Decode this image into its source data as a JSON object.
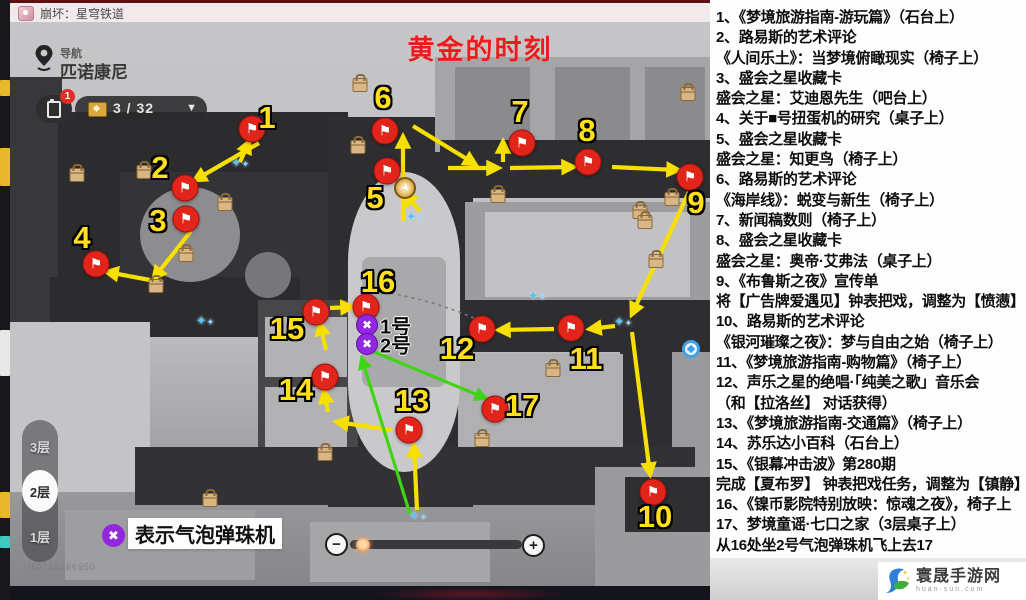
{
  "window": {
    "title": "崩坏：星穹铁道"
  },
  "map": {
    "overlay_title": "黄金的时刻",
    "nav_label": "导航",
    "nav_location": "匹诺康尼",
    "collection_count": "3 / 32",
    "tasks_badge": "1",
    "floors": [
      {
        "label": "3层",
        "selected": false
      },
      {
        "label": "2层",
        "selected": true
      },
      {
        "label": "1层",
        "selected": false
      }
    ],
    "legend": {
      "symbol": "✖",
      "label": "表示气泡弹珠机"
    },
    "uid": "UID116166950",
    "zoom_controls": {
      "minus": "−",
      "plus": "+"
    },
    "flag_symbol": "⚑",
    "markers": [
      {
        "n": "1",
        "fx": 242,
        "fy": 107,
        "lx": 257,
        "ly": 96
      },
      {
        "n": "2",
        "fx": 175,
        "fy": 166,
        "lx": 150,
        "ly": 146
      },
      {
        "n": "3",
        "fx": 176,
        "fy": 197,
        "lx": 148,
        "ly": 199
      },
      {
        "n": "4",
        "fx": 86,
        "fy": 242,
        "lx": 72,
        "ly": 216
      },
      {
        "n": "5",
        "fx": 377,
        "fy": 149,
        "lx": 365,
        "ly": 176
      },
      {
        "n": "6",
        "fx": 375,
        "fy": 109,
        "lx": 373,
        "ly": 76
      },
      {
        "n": "7",
        "fx": 512,
        "fy": 121,
        "lx": 510,
        "ly": 90
      },
      {
        "n": "8",
        "fx": 578,
        "fy": 140,
        "lx": 577,
        "ly": 109
      },
      {
        "n": "9",
        "fx": 680,
        "fy": 155,
        "lx": 686,
        "ly": 181
      },
      {
        "n": "10",
        "fx": 643,
        "fy": 470,
        "lx": 645,
        "ly": 495
      },
      {
        "n": "11",
        "fx": 561,
        "fy": 306,
        "lx": 576,
        "ly": 337
      },
      {
        "n": "12",
        "fx": 472,
        "fy": 307,
        "lx": 447,
        "ly": 327
      },
      {
        "n": "13",
        "fx": 399,
        "fy": 408,
        "lx": 402,
        "ly": 379
      },
      {
        "n": "14",
        "fx": 315,
        "fy": 355,
        "lx": 286,
        "ly": 368
      },
      {
        "n": "15",
        "fx": 306,
        "fy": 290,
        "lx": 277,
        "ly": 307
      },
      {
        "n": "16",
        "fx": 356,
        "fy": 285,
        "lx": 368,
        "ly": 260
      },
      {
        "n": "17",
        "fx": 485,
        "fy": 387,
        "lx": 512,
        "ly": 384
      }
    ],
    "machines": [
      {
        "label": "1号",
        "x": 357,
        "y": 303
      },
      {
        "label": "2号",
        "x": 357,
        "y": 322
      }
    ],
    "arrows": [
      {
        "x1": 230,
        "y1": 140,
        "x2": 239,
        "y2": 120,
        "c": "y"
      },
      {
        "x1": 249,
        "y1": 121,
        "x2": 185,
        "y2": 158,
        "c": "y"
      },
      {
        "x1": 181,
        "y1": 209,
        "x2": 144,
        "y2": 256,
        "c": "y"
      },
      {
        "x1": 140,
        "y1": 258,
        "x2": 97,
        "y2": 250,
        "c": "y"
      },
      {
        "x1": 393,
        "y1": 199,
        "x2": 393,
        "y2": 115,
        "c": "y"
      },
      {
        "x1": 410,
        "y1": 189,
        "x2": 395,
        "y2": 172,
        "c": "y"
      },
      {
        "x1": 403,
        "y1": 104,
        "x2": 465,
        "y2": 142,
        "c": "y"
      },
      {
        "x1": 438,
        "y1": 146,
        "x2": 488,
        "y2": 146,
        "c": "y"
      },
      {
        "x1": 493,
        "y1": 140,
        "x2": 493,
        "y2": 120,
        "c": "y"
      },
      {
        "x1": 500,
        "y1": 146,
        "x2": 563,
        "y2": 145,
        "c": "y"
      },
      {
        "x1": 602,
        "y1": 145,
        "x2": 668,
        "y2": 148,
        "c": "y"
      },
      {
        "x1": 679,
        "y1": 170,
        "x2": 622,
        "y2": 292,
        "c": "y"
      },
      {
        "x1": 605,
        "y1": 304,
        "x2": 580,
        "y2": 307,
        "c": "y"
      },
      {
        "x1": 544,
        "y1": 307,
        "x2": 489,
        "y2": 308,
        "c": "y"
      },
      {
        "x1": 622,
        "y1": 310,
        "x2": 640,
        "y2": 452,
        "c": "y"
      },
      {
        "x1": 407,
        "y1": 488,
        "x2": 404,
        "y2": 424,
        "c": "y"
      },
      {
        "x1": 382,
        "y1": 408,
        "x2": 327,
        "y2": 400,
        "c": "y"
      },
      {
        "x1": 318,
        "y1": 390,
        "x2": 314,
        "y2": 370,
        "c": "y"
      },
      {
        "x1": 316,
        "y1": 328,
        "x2": 310,
        "y2": 302,
        "c": "y"
      },
      {
        "x1": 320,
        "y1": 286,
        "x2": 342,
        "y2": 285,
        "c": "y"
      },
      {
        "x1": 400,
        "y1": 492,
        "x2": 352,
        "y2": 337,
        "c": "g"
      },
      {
        "x1": 362,
        "y1": 329,
        "x2": 475,
        "y2": 376,
        "c": "g"
      }
    ],
    "props": [
      [
        350,
        63
      ],
      [
        67,
        153
      ],
      [
        348,
        125
      ],
      [
        176,
        233
      ],
      [
        146,
        264
      ],
      [
        215,
        182
      ],
      [
        488,
        174
      ],
      [
        630,
        190
      ],
      [
        662,
        177
      ],
      [
        635,
        200
      ],
      [
        646,
        239
      ],
      [
        543,
        348
      ],
      [
        472,
        418
      ],
      [
        315,
        432
      ],
      [
        200,
        478
      ],
      [
        678,
        72
      ],
      [
        134,
        150
      ]
    ],
    "sparkles": [
      [
        230,
        141
      ],
      [
        405,
        195
      ],
      [
        527,
        274
      ],
      [
        613,
        300
      ],
      [
        408,
        494
      ],
      [
        195,
        299
      ]
    ],
    "player": {
      "x": 395,
      "y": 166
    },
    "teleport": {
      "x": 681,
      "y": 327
    }
  },
  "guide_panel": {
    "lines": [
      "1、《梦境旅游指南-游玩篇》（石台上）",
      "2、路易斯的艺术评论",
      "《人间乐土》：当梦境俯瞰现实（椅子上）",
      "3、盛会之星收藏卡",
      "盛会之星：艾迪恩先生（吧台上）",
      "4、关于■号扭蛋机的研究（桌子上）",
      "5、盛会之星收藏卡",
      "盛会之星：知更鸟（椅子上）",
      "6、路易斯的艺术评论",
      "《海岸线》：蜕变与新生（椅子上）",
      "7、新闻稿数则（椅子上）",
      "8、盛会之星收藏卡",
      "盛会之星：奥帝·艾弗法（桌子上）",
      "9、《布鲁斯之夜》宣传单",
      "将【广告牌爱遇见】钟表把戏，调整为【愤懑】",
      "10、路易斯的艺术评论",
      "《银河璀璨之夜》：梦与自由之始（椅子上）",
      "11、《梦境旅游指南-购物篇》（椅子上）",
      "12、声乐之星的绝唱·「纯美之歌」音乐会",
      "（和【拉洛丝】 对话获得）",
      "13、《梦境旅游指南-交通篇》（椅子上）",
      "14、苏乐达小百科（石台上）",
      "15、《银幕冲击波》第280期",
      "完成【夏布罗】 钟表把戏任务，调整为【镇静】",
      "16、《镍币影院特别放映：惊魂之夜》，椅子上",
      "17、梦境童谣·七口之家（3层桌子上）",
      "从16处坐2号气泡弹珠机飞上去17"
    ]
  },
  "watermark": {
    "site_name": "寰晟手游网",
    "site_url": "huan·sun.com"
  },
  "colors": {
    "title_red": "#ed1c1c",
    "flag_red": "#e1251b",
    "number_yellow": "#ffe01a",
    "arrow_yellow": "#f7df00",
    "arrow_green": "#3fd514",
    "machine_purple": "#9327e0",
    "panel_bg": "#fefefe"
  }
}
